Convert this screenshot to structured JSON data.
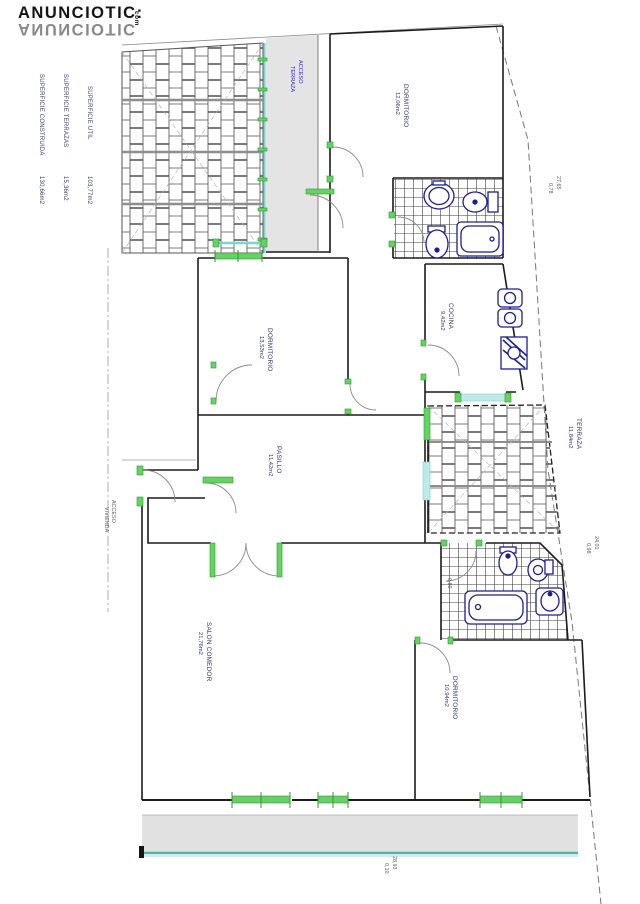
{
  "watermark": {
    "brand": "ANUNCIOTIC",
    "colon": ":",
    "tld": "com"
  },
  "legend": {
    "items": [
      {
        "label": "SUPERFICIE CONSTRUIDA",
        "value": "130,66m2"
      },
      {
        "label": "SUPERFICIE TERRAZAS",
        "value": "15,36m2"
      },
      {
        "label": "SUPERFICIE UTIL",
        "value": "103,77m2"
      }
    ]
  },
  "rooms": {
    "dormitorio_top": {
      "name": "DORMITORIO",
      "area": "12,06m2"
    },
    "acceso": {
      "line1": "ACCESO",
      "line2": "TERRAZA"
    },
    "dormitorio_mid": {
      "name": "DORMITORIO",
      "area": "13,53m2"
    },
    "pasillo": {
      "name": "PASILLO",
      "area": "11,42m2"
    },
    "cocina": {
      "name": "COCINA",
      "area": "9,42m2"
    },
    "terraza": {
      "name": "TERRAZA",
      "area": "11,84m2"
    },
    "salon": {
      "name": "SALON COMEDOR",
      "area": "21,76m2"
    },
    "dormitorio_bottom": {
      "name": "DORMITORIO",
      "area": "10,94m2"
    },
    "entrada": {
      "line1": "ACCESO",
      "line2": "VIVIENDA"
    }
  },
  "dimensions": {
    "d1": "27,65",
    "d1b": "0,78",
    "d2": "24,01",
    "d2b": "0,98",
    "d3": "28,93",
    "d3b": "0,10",
    "d4": "0,80"
  },
  "colors": {
    "wall": "#222222",
    "door_green": "#66d166",
    "glazing_cyan": "#8fd8d4",
    "balcony_teal": "#4fb3ab",
    "fixture_navy": "#1e1e8f",
    "label_navy": "#32326a",
    "terrace_gray": "#e3e3e3",
    "dim_gray": "#5a5a5a"
  }
}
